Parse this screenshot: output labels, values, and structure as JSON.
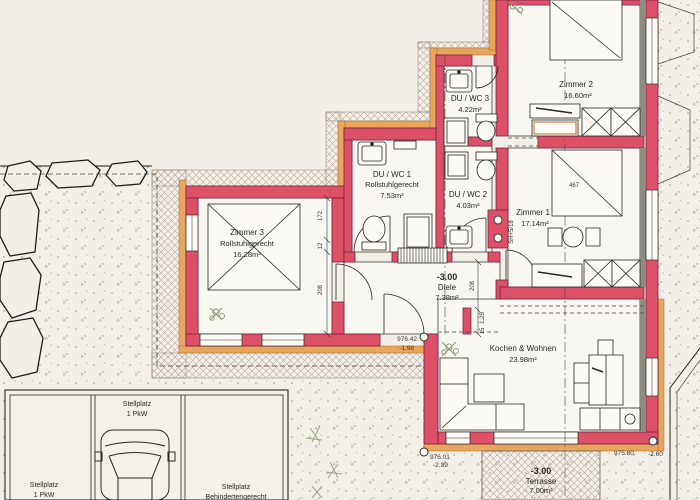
{
  "document": {
    "kind": "architectural floor plan (scanned)"
  },
  "colors": {
    "wall_red": "#dc5168",
    "wall_outline": "#7e2040",
    "accent_orange": "#e8a55e",
    "insulation_gray": "#8c8c80",
    "paper": "#f2efe8",
    "room_fill": "#f9f7f1",
    "hatch_line": "#b9a99b",
    "ink": "#2a2825",
    "plant_green": "#8a9a7a"
  },
  "rooms": [
    {
      "name": "Zimmer 2",
      "area": "16.60m²"
    },
    {
      "name": "DU / WC 3",
      "area": "4.22m²"
    },
    {
      "name": "DU / WC 1",
      "note": "Rollstuhlgerecht",
      "area": "7.53m²"
    },
    {
      "name": "DU / WC 2",
      "area": "4.03m²"
    },
    {
      "name": "Zimmer 1",
      "area": "17.14m²"
    },
    {
      "name": "Zimmer 3",
      "note": "Rollstuhlgerecht",
      "area": "16.28m²"
    },
    {
      "level": "-3.00",
      "name": "Diele",
      "area": "7.38m²"
    },
    {
      "name": "Kochen & Wohnen",
      "area": "23.98m²"
    },
    {
      "level": "-3.00",
      "name": "Terrasse",
      "area": "7.00m²"
    }
  ],
  "parking": {
    "stalls": [
      {
        "line1": "Stellplatz",
        "line2": "1 PkW"
      },
      {
        "line1": "Stellplatz",
        "line2": "1 PkW"
      },
      {
        "line1": "Stellplatz",
        "line2": "Behindertengerecht"
      }
    ]
  },
  "elevations": [
    {
      "height": "976.42",
      "depth": "-1.98"
    },
    {
      "height": "976.01",
      "depth": "-2.39"
    },
    {
      "height": "975.80",
      "depth": "-2.60"
    }
  ],
  "dimensions": {
    "d467": "467",
    "v172": "172",
    "v12": "12",
    "v208a": "208",
    "v208b": "208",
    "v15": "15",
    "v125": "1.25",
    "sill": "SH+5/18"
  }
}
